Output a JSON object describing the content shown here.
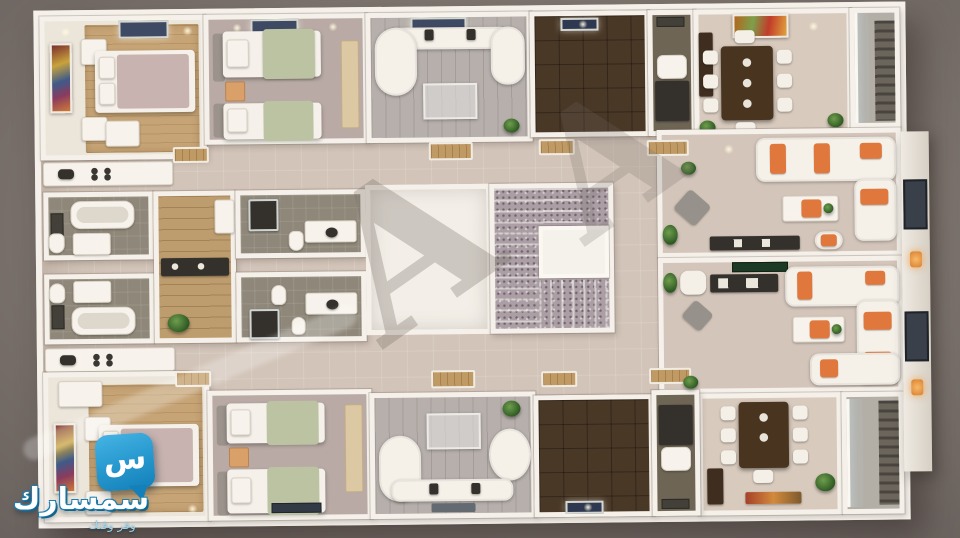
{
  "scene": {
    "type": "3D architectural floor-plan render, top-down view",
    "description": "Residential floor with two mirrored apartments (bedrooms, bathrooms, kitchens, living rooms), a central granite staircase core, twin reception salons with orange-accent sofas, dining rooms and balconies",
    "background_color": "#7e756f",
    "wall_color": "#f5f1ea",
    "floors": {
      "hall_tile": "#d2c4b8",
      "bedroom_carpet_tan": "#c6a476",
      "bedroom_carpet_mauve": "#b9aaa5",
      "living_planks": "#b6afab",
      "dark_tile": "#4a3827",
      "bathroom": "#8f887a",
      "corridor_wood": "#bd9c6e",
      "granite_stairs": "#ab9fa5",
      "balcony": "#b3aea6"
    },
    "accents": {
      "sofa_orange": "#e0773c",
      "plant_green": "#2e5a23",
      "ceiling_window_navy": "#3e4a64",
      "bed_blanket_green": "#bcc3a3",
      "bed_blanket_mauve": "#c9b3b0",
      "dark_furniture": "#34302b",
      "wall_lamp_orange": "#f2a24b"
    }
  },
  "watermark": {
    "letters": [
      "A",
      "A"
    ]
  },
  "logo": {
    "brand": "سمسارك",
    "tagline": "وفر وقتك",
    "icon_glyph": "س",
    "bubble_top": "#45b3e4",
    "bubble_bottom": "#1480b9",
    "text_color": "#ffffff",
    "outline_color": "#1c7fb3",
    "tagline_color": "#9bd4ee"
  },
  "rooms": [
    {
      "id": "master-bedroom-top",
      "label": "Master bedroom (top apartment)",
      "items": [
        "wall-art",
        "double-bed",
        "nightstands",
        "bench",
        "ceiling-window",
        "tan-carpet"
      ]
    },
    {
      "id": "twin-bedroom-top",
      "label": "Twin bedroom (top apartment)",
      "items": [
        "single-bed",
        "single-bed",
        "orange-nightstand",
        "wardrobe",
        "ceiling-window"
      ]
    },
    {
      "id": "living-room-top",
      "label": "Living room (top apartment)",
      "items": [
        "curved-sectional-sofa",
        "glass-coffee-table",
        "plant",
        "ceiling-window"
      ]
    },
    {
      "id": "tiled-room-top",
      "label": "Dark tiled room (top apartment)",
      "items": [
        "ceiling-light"
      ]
    },
    {
      "id": "bathroom-small-top",
      "label": "Small bathroom (top apartment)",
      "items": [
        "vanity",
        "sink",
        "mirror"
      ]
    },
    {
      "id": "dining-room-top",
      "label": "Dining room (top apartment)",
      "items": [
        "dining-table",
        "eight-chairs",
        "wall-painting",
        "cabinet",
        "plants"
      ]
    },
    {
      "id": "balcony-top",
      "label": "Balcony (top right)",
      "items": [
        "glass-wall",
        "slat-screen"
      ]
    },
    {
      "id": "kitchen-top",
      "label": "Kitchenette counter (top apartment)",
      "items": [
        "counter",
        "cooktop",
        "sink"
      ]
    },
    {
      "id": "bathroom-a",
      "label": "Bathroom with tub (top apartment)",
      "items": [
        "bathtub",
        "toilet",
        "mirror",
        "shower-box"
      ]
    },
    {
      "id": "bathroom-b",
      "label": "Bathroom with tub (bottom apartment)",
      "items": [
        "bathtub",
        "toilet",
        "mirror",
        "shower-box"
      ]
    },
    {
      "id": "corridor-wood",
      "label": "Wood corridor between bathrooms",
      "items": [
        "dark-console",
        "cabinet",
        "plant"
      ]
    },
    {
      "id": "bathroom-c",
      "label": "Ensuite bathroom (top apartment)",
      "items": [
        "shower",
        "toilet",
        "vanity"
      ]
    },
    {
      "id": "bathroom-d",
      "label": "Ensuite bathroom (bottom apartment)",
      "items": [
        "shower",
        "toilet",
        "bidet",
        "vanity"
      ]
    },
    {
      "id": "stair-landing",
      "label": "Stair landing / lobby",
      "items": []
    },
    {
      "id": "staircase",
      "label": "Granite staircase core",
      "items": [
        "stair-flights",
        "elevator-box"
      ]
    },
    {
      "id": "salon-top",
      "label": "Reception salon (top)",
      "items": [
        "l-sofa-orange-cushions",
        "coffee-table",
        "tv-console",
        "armchair",
        "gray-rug",
        "plant"
      ]
    },
    {
      "id": "salon-bottom",
      "label": "Reception salon (bottom)",
      "items": [
        "u-sofa-orange-cushions",
        "coffee-table",
        "black-desk",
        "desk-chair",
        "green-top-cabinet",
        "gray-rug",
        "plant"
      ]
    },
    {
      "id": "dining-room-bottom",
      "label": "Dining room (bottom apartment)",
      "items": [
        "dining-table",
        "seven-chairs",
        "cabinet",
        "colorful-rug",
        "plant"
      ]
    },
    {
      "id": "balcony-bottom",
      "label": "Balcony (bottom right)",
      "items": [
        "glass-wall",
        "slat-screen"
      ]
    },
    {
      "id": "kitchen-bottom",
      "label": "Kitchenette counter (bottom apartment)",
      "items": [
        "counter",
        "cooktop",
        "sink"
      ]
    },
    {
      "id": "master-bedroom-bottom",
      "label": "Master bedroom (bottom apartment)",
      "items": [
        "wall-art",
        "double-bed",
        "nightstands",
        "wardrobe",
        "tan-carpet"
      ]
    },
    {
      "id": "twin-bedroom-bottom",
      "label": "Twin bedroom (bottom apartment)",
      "items": [
        "single-bed",
        "single-bed",
        "orange-nightstand",
        "wardrobe",
        "tv-panel"
      ]
    },
    {
      "id": "living-room-bottom",
      "label": "Living room (bottom apartment)",
      "items": [
        "curved-sectional-sofa",
        "glass-coffee-table",
        "plant",
        "rug"
      ]
    },
    {
      "id": "tiled-room-bottom",
      "label": "Dark tiled room (bottom apartment)",
      "items": [
        "ceiling-light"
      ]
    },
    {
      "id": "bathroom-small-bottom",
      "label": "Small bathroom (bottom apartment)",
      "items": [
        "vanity",
        "sink",
        "mirror"
      ]
    }
  ]
}
